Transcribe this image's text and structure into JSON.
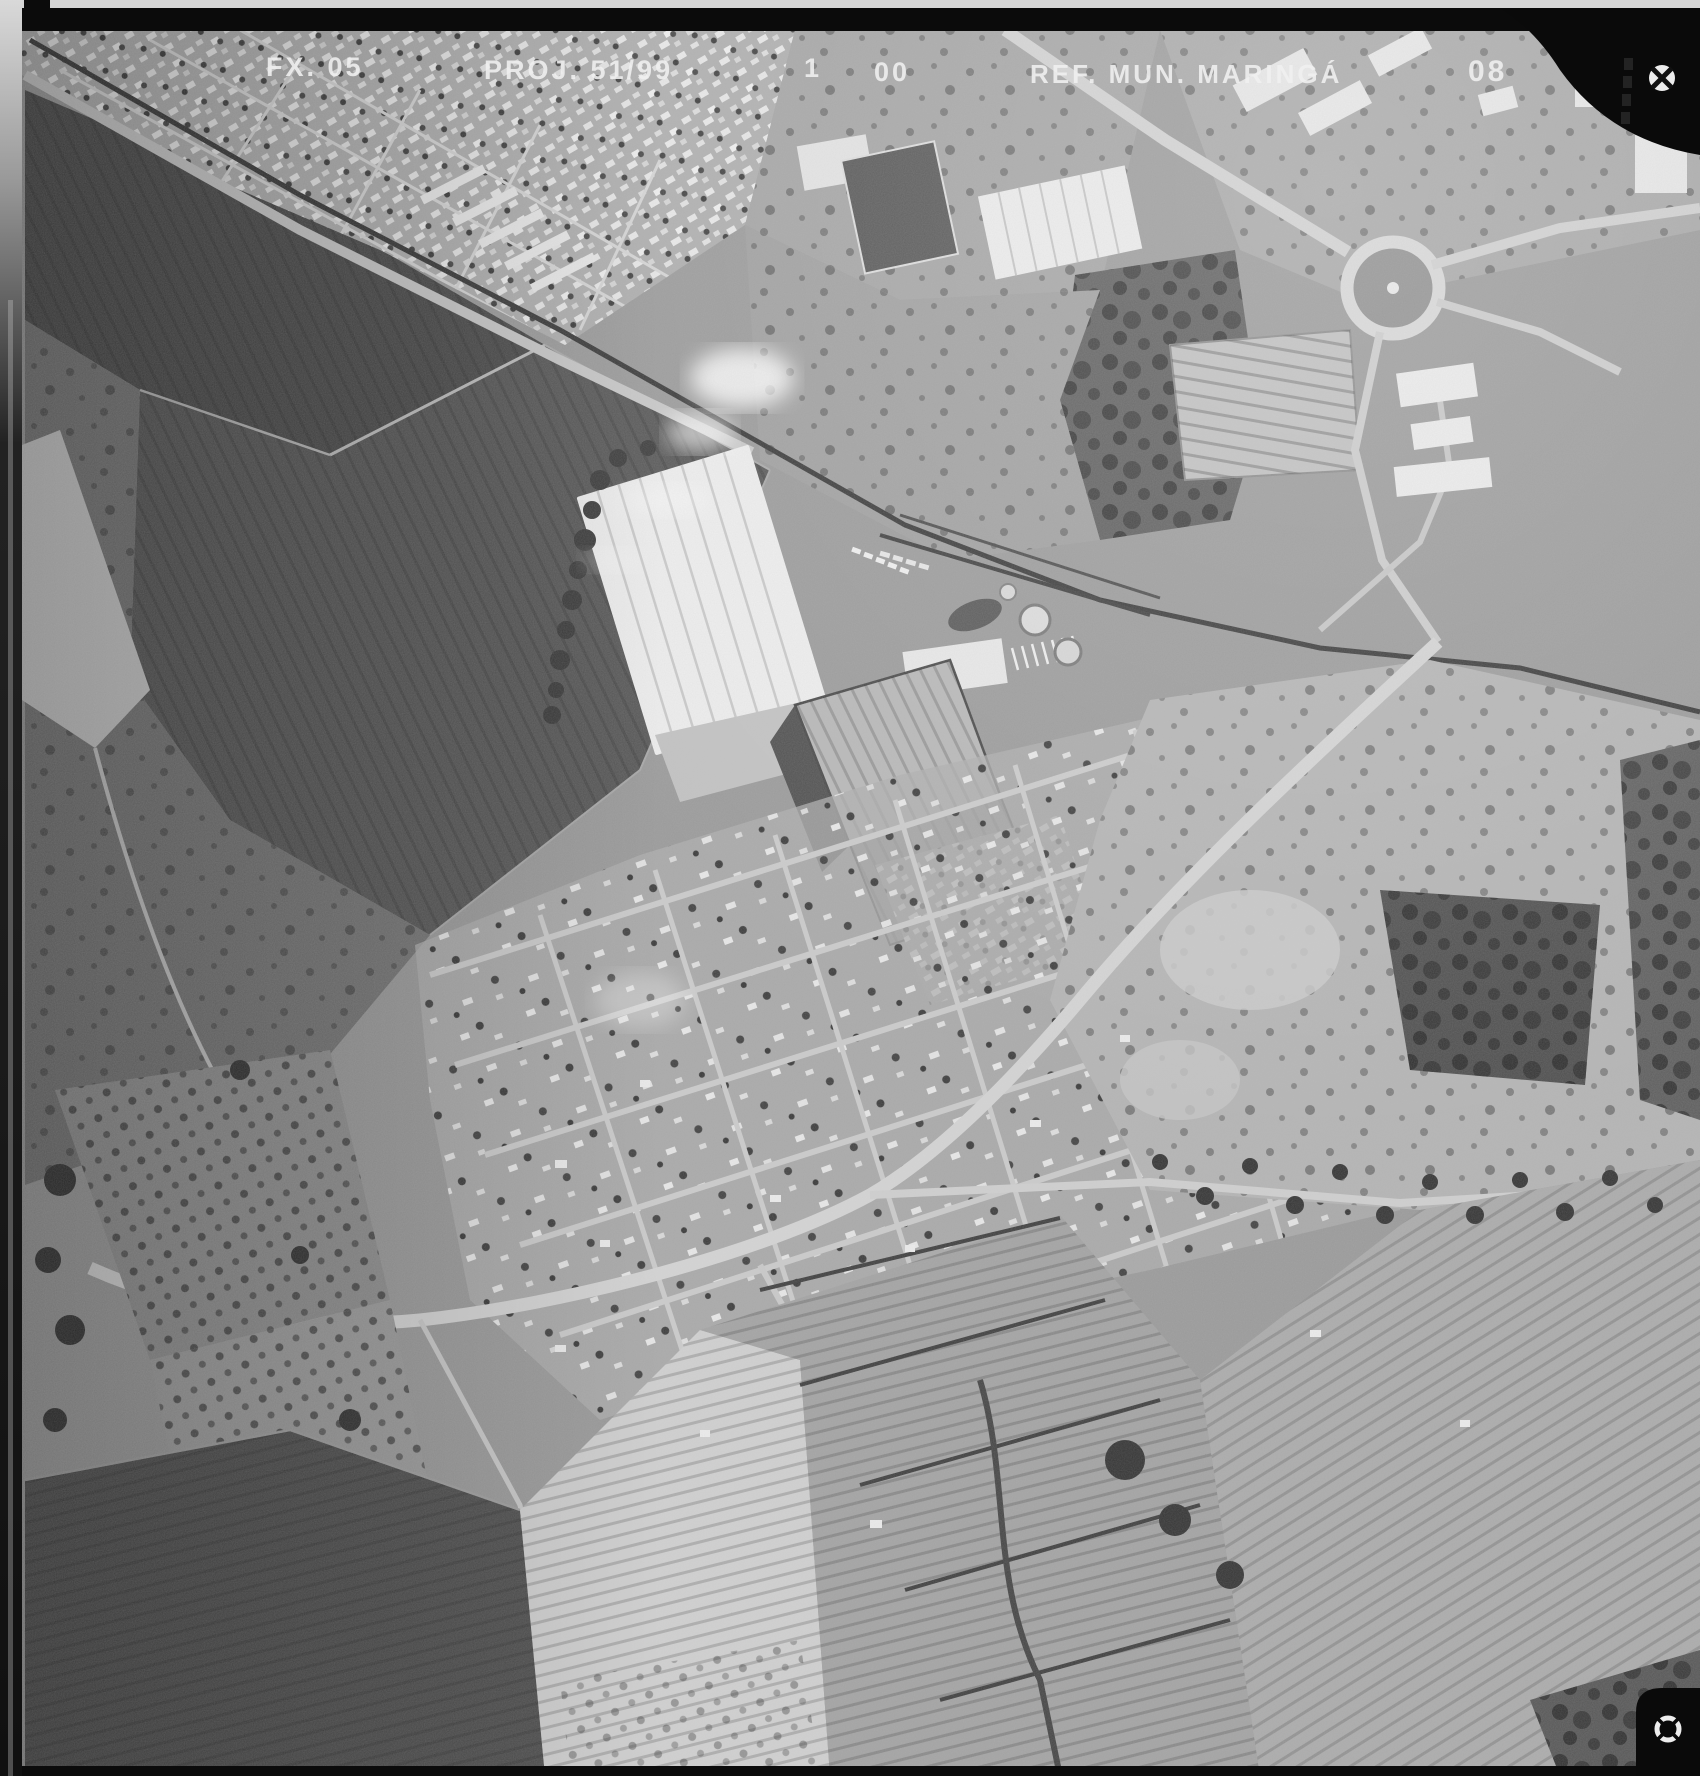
{
  "photo": {
    "alt": "Black-and-white vertical aerial survey photograph: railway and highway corridor with roundabout at top right, large white warehouse and rail yard at center, dark cultivated fields on the left, expanding residential street grid in the lower middle, orchards and row-crop fields at the bottom."
  },
  "annotation": {
    "tokens": [
      {
        "text": "FX. 05"
      },
      {
        "text": "PROJ. 51/99"
      },
      {
        "text": "1"
      },
      {
        "text": "00"
      },
      {
        "text": "REF. MUN. MARINGÁ"
      },
      {
        "text": "08"
      }
    ]
  },
  "frame": {
    "film_edge_color": "#0b0b0b",
    "annotation_color": "#f1f1f1",
    "paper_edge_color": "#d6d6d6"
  },
  "fiducials": [
    {
      "name": "top-right-crosshair"
    },
    {
      "name": "bottom-right-crosshair"
    }
  ]
}
